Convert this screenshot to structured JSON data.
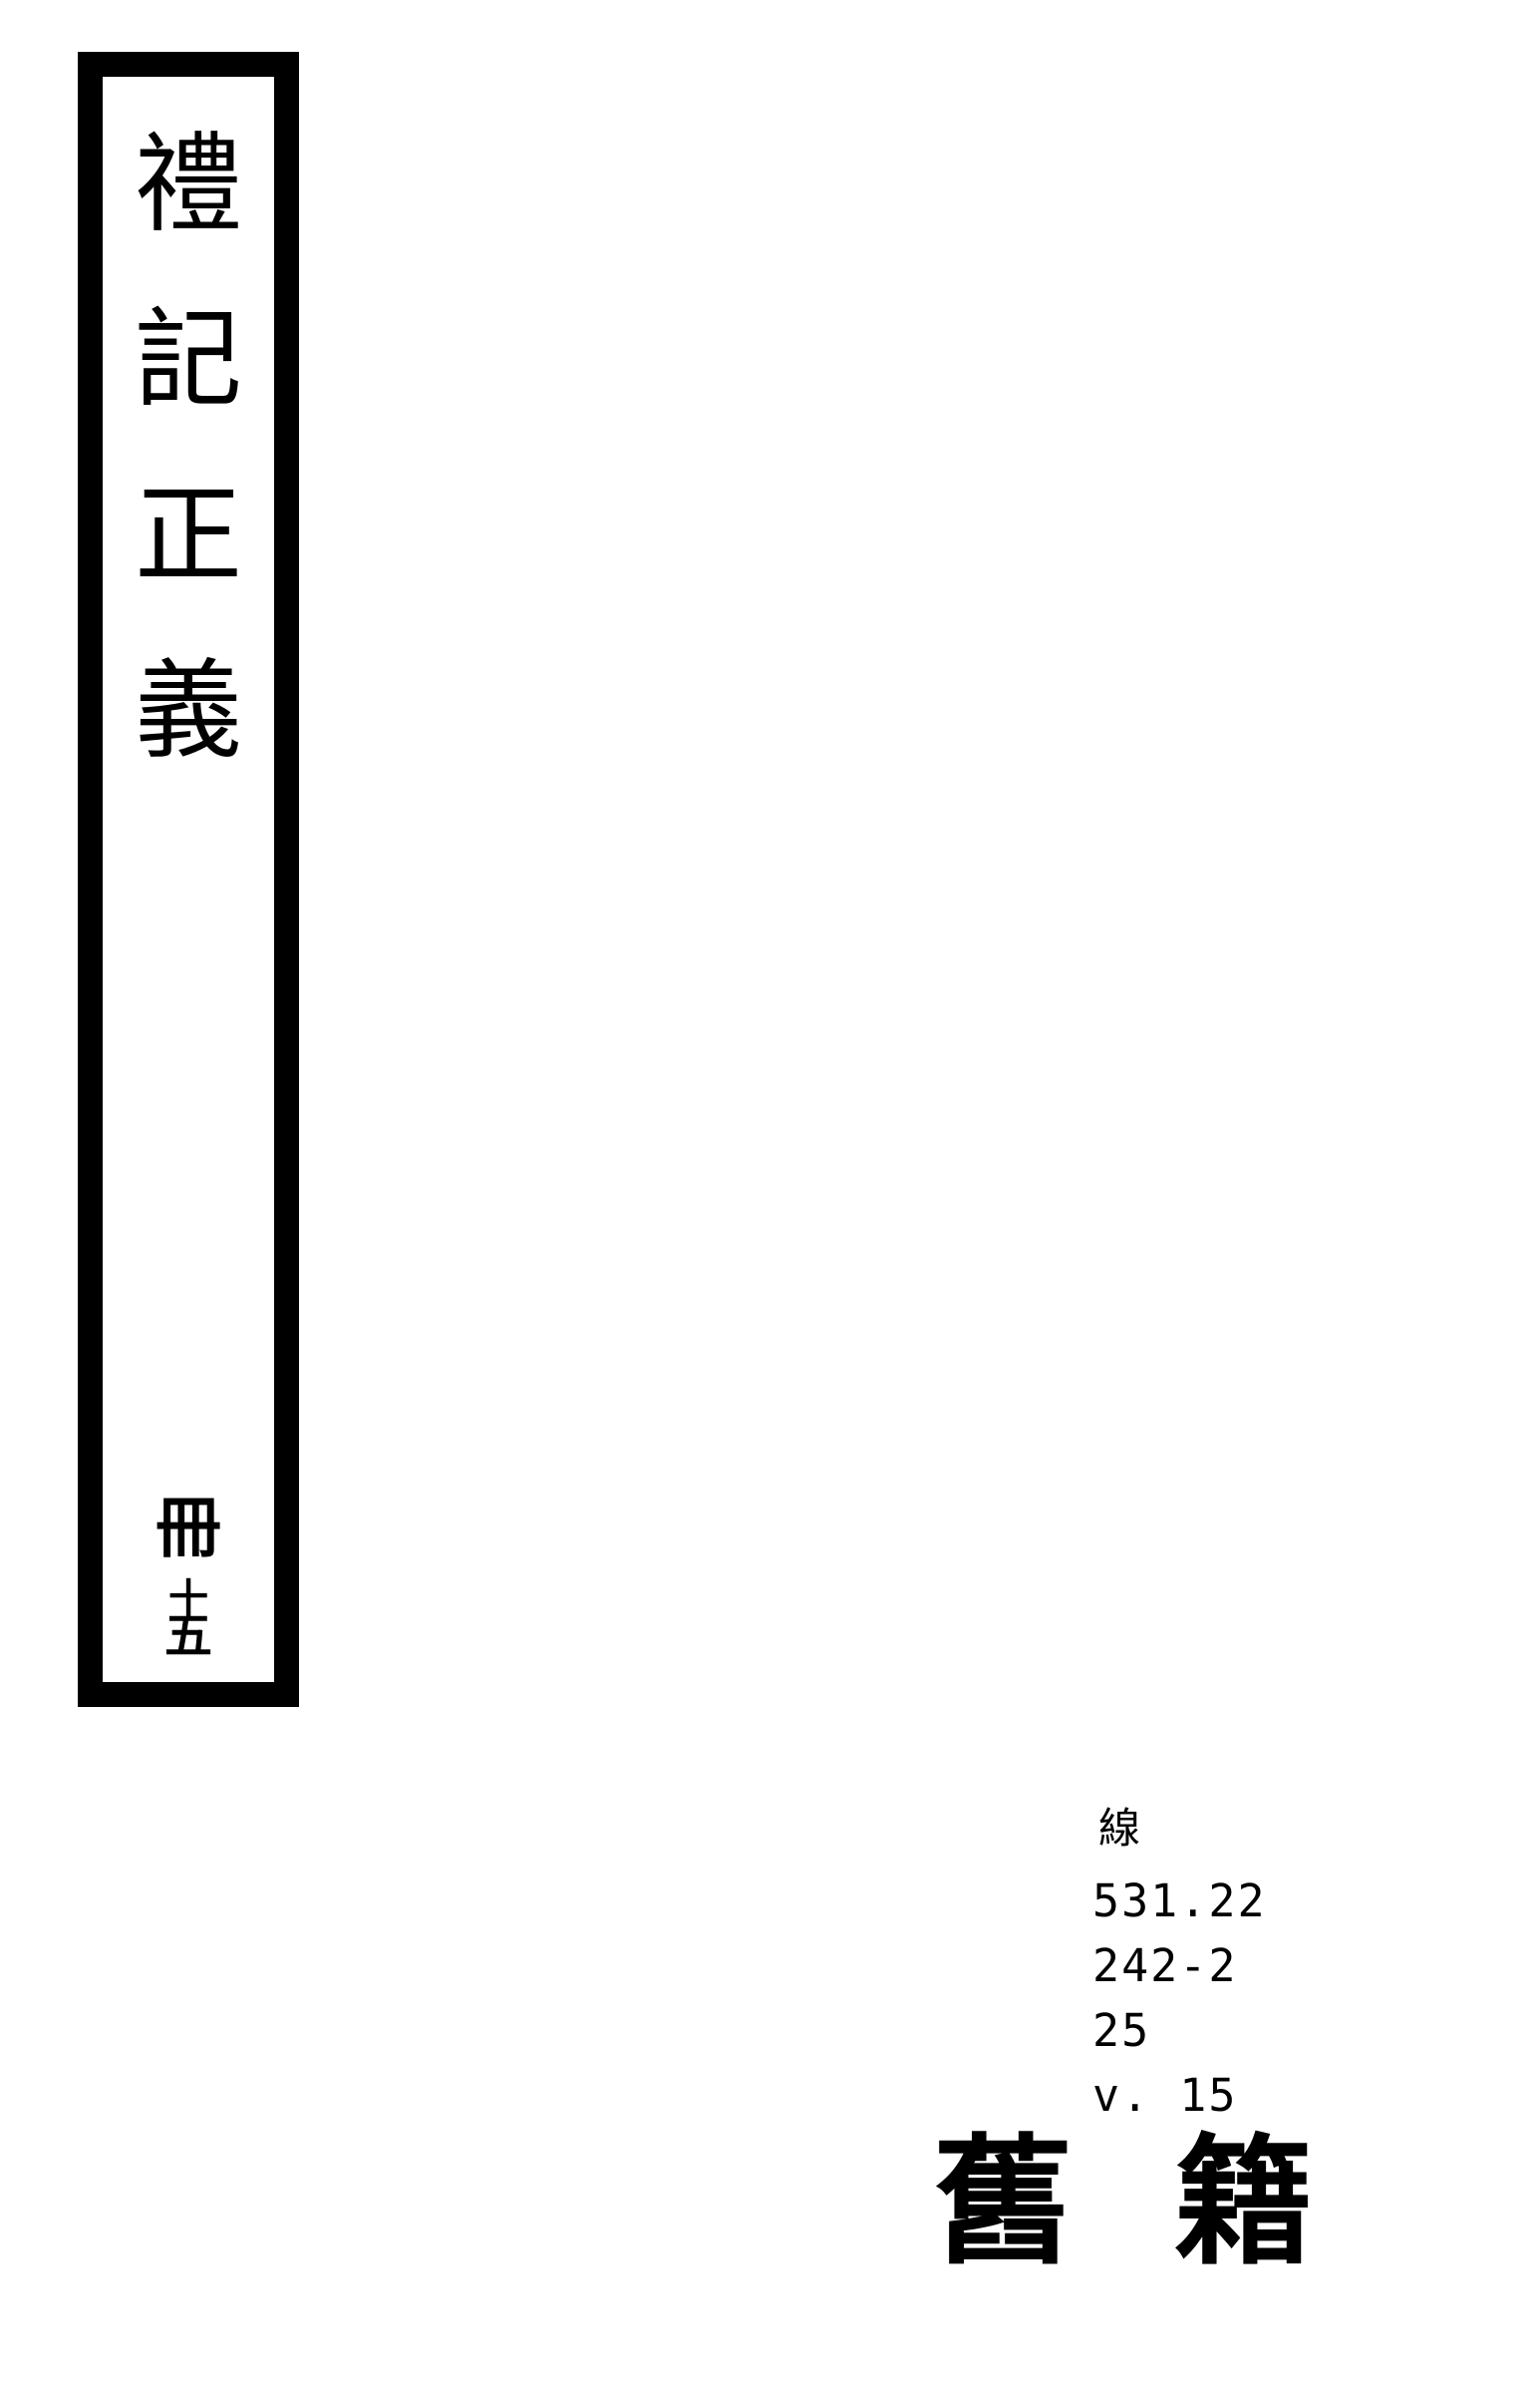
{
  "spine": {
    "title": "禮記正義",
    "title_chars": [
      "禮",
      "記",
      "正",
      "義"
    ],
    "volume": {
      "text": "冊十五",
      "booklet_char": "冊",
      "ten_char": "十",
      "five_char": "五"
    }
  },
  "call_number": {
    "class_char": "線",
    "lines": [
      "531.22",
      "242-2",
      "25",
      "v. 15"
    ]
  },
  "stamp": {
    "text": "舊籍",
    "chars": [
      "舊",
      "籍"
    ]
  },
  "colors": {
    "ink": "#000000",
    "background": "#ffffff"
  }
}
